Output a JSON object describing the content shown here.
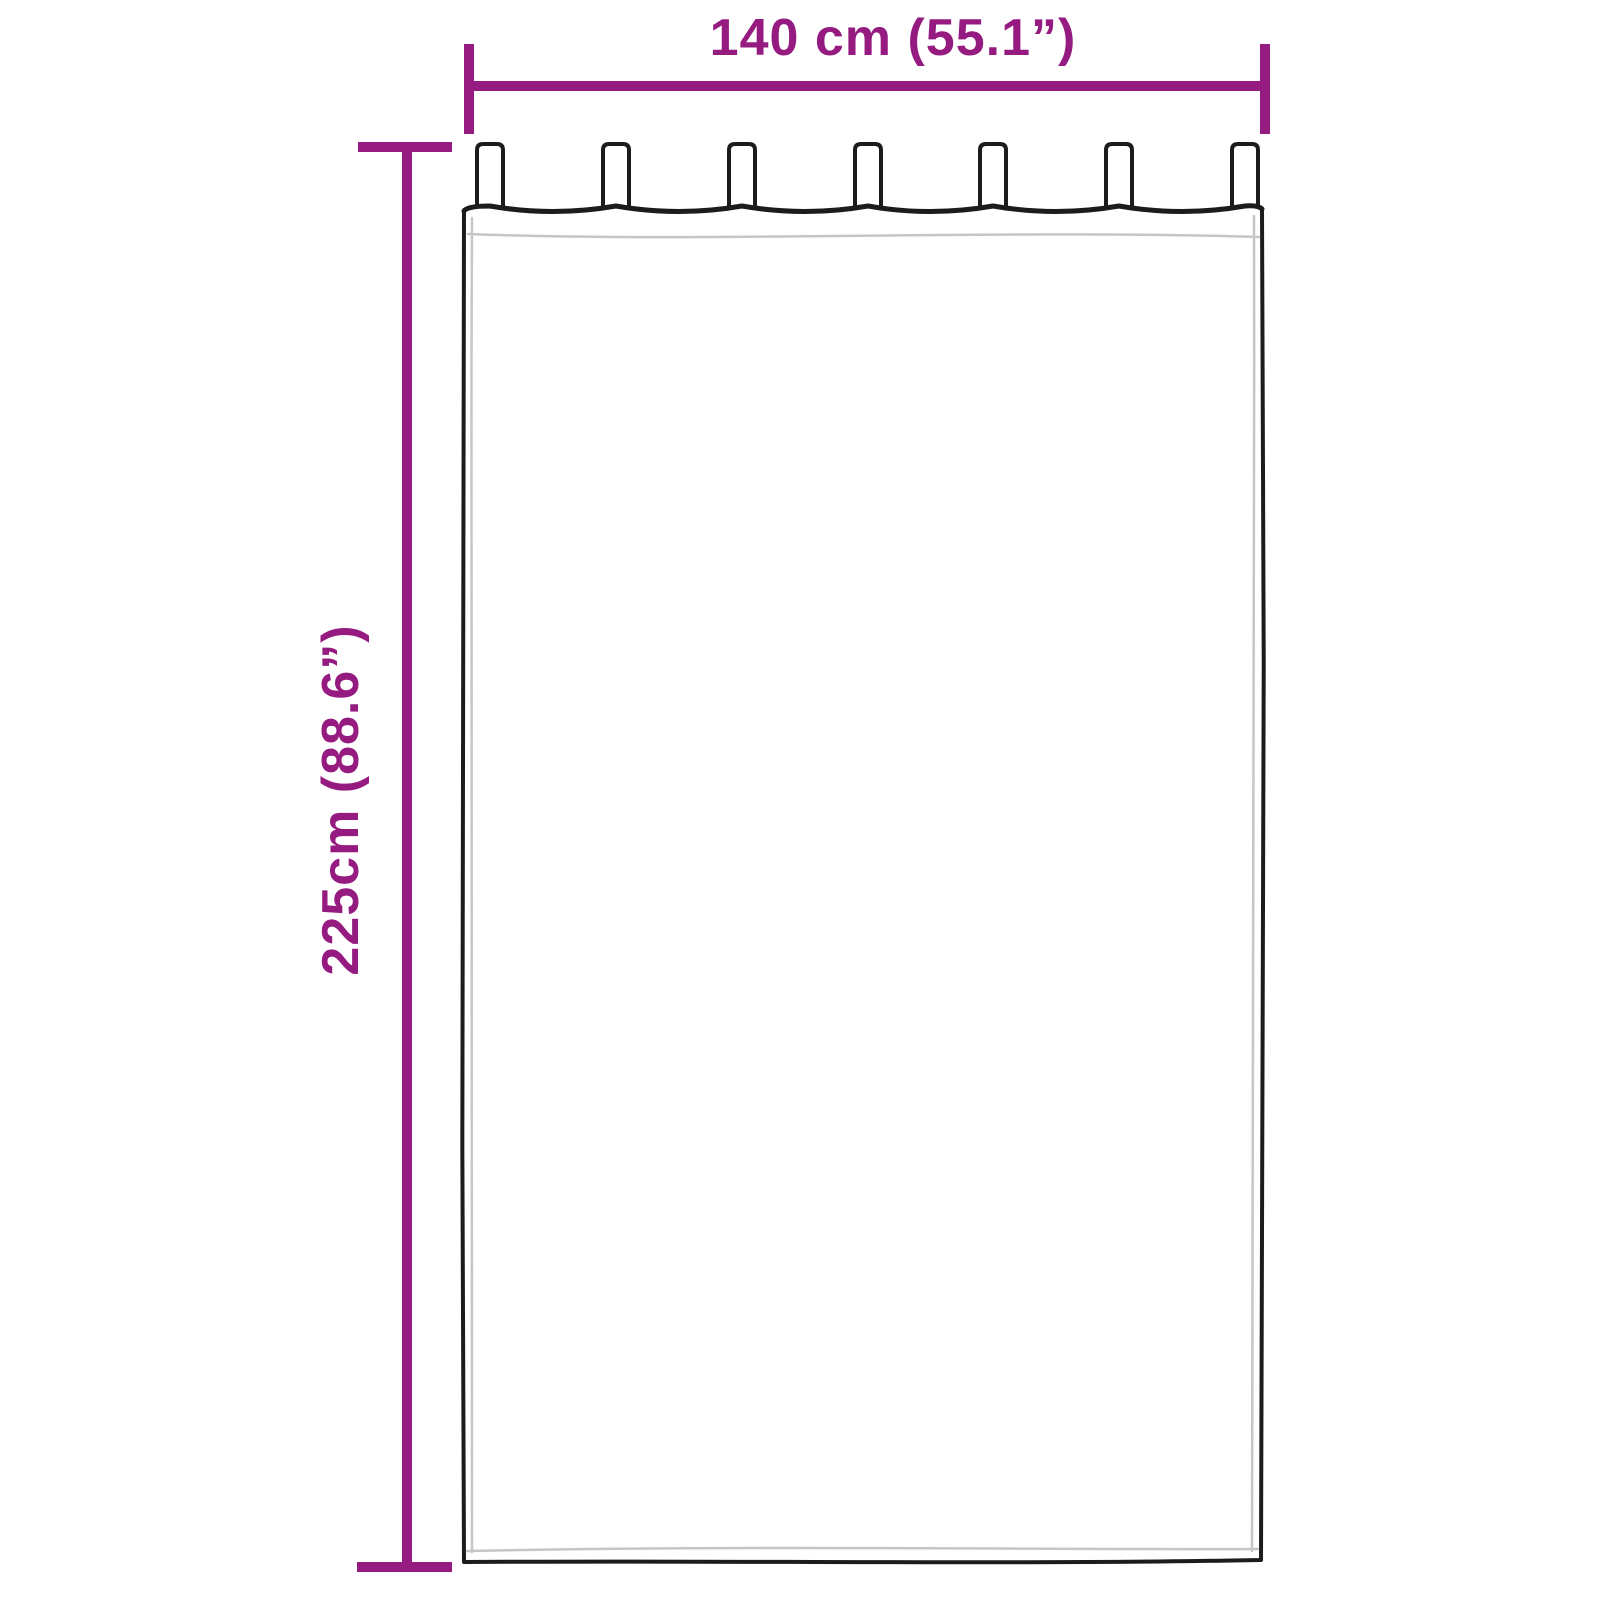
{
  "diagram": {
    "width_label": "140 cm (55.1”)",
    "height_label": "225cm (88.6”)",
    "tab_count": 7,
    "colors": {
      "accent": "#951b81",
      "outline": "#1c1c1c",
      "hem": "#c6c6c6",
      "background": "#ffffff"
    }
  }
}
